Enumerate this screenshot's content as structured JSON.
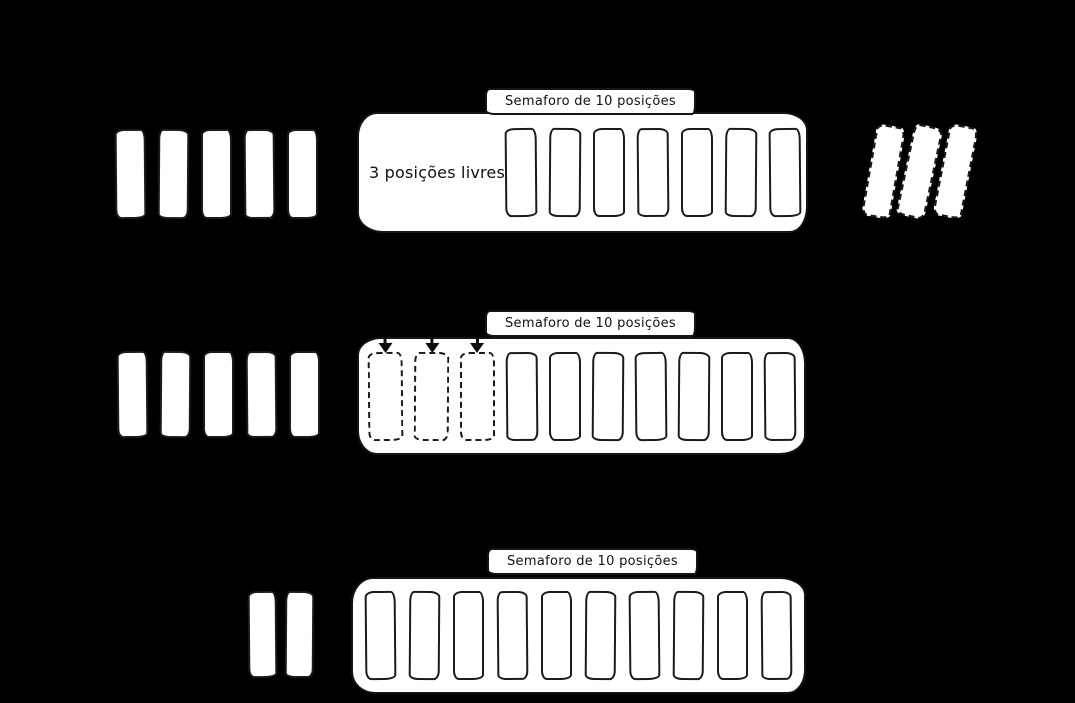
{
  "palette": {
    "background": "#000000",
    "shape_fill": "#ffffff",
    "stroke": "#1b1b1b"
  },
  "icons": {
    "pending_slot_marker": "down-arrow"
  },
  "rows": [
    {
      "left_tokens": 5,
      "right_tokens_dashed": 3,
      "semaphore": {
        "label": "Semaforo de 10 posições",
        "free_text": "3 posições livres",
        "total_positions": 10,
        "occupied_slots": 7,
        "pending_slots": 0
      }
    },
    {
      "left_tokens": 5,
      "right_tokens_dashed": 0,
      "semaphore": {
        "label": "Semaforo de 10 posições",
        "total_positions": 10,
        "occupied_slots": 7,
        "pending_slots": 3
      }
    },
    {
      "left_tokens": 2,
      "right_tokens_dashed": 0,
      "semaphore": {
        "label": "Semaforo de 10 posições",
        "total_positions": 10,
        "occupied_slots": 10,
        "pending_slots": 0
      }
    }
  ]
}
